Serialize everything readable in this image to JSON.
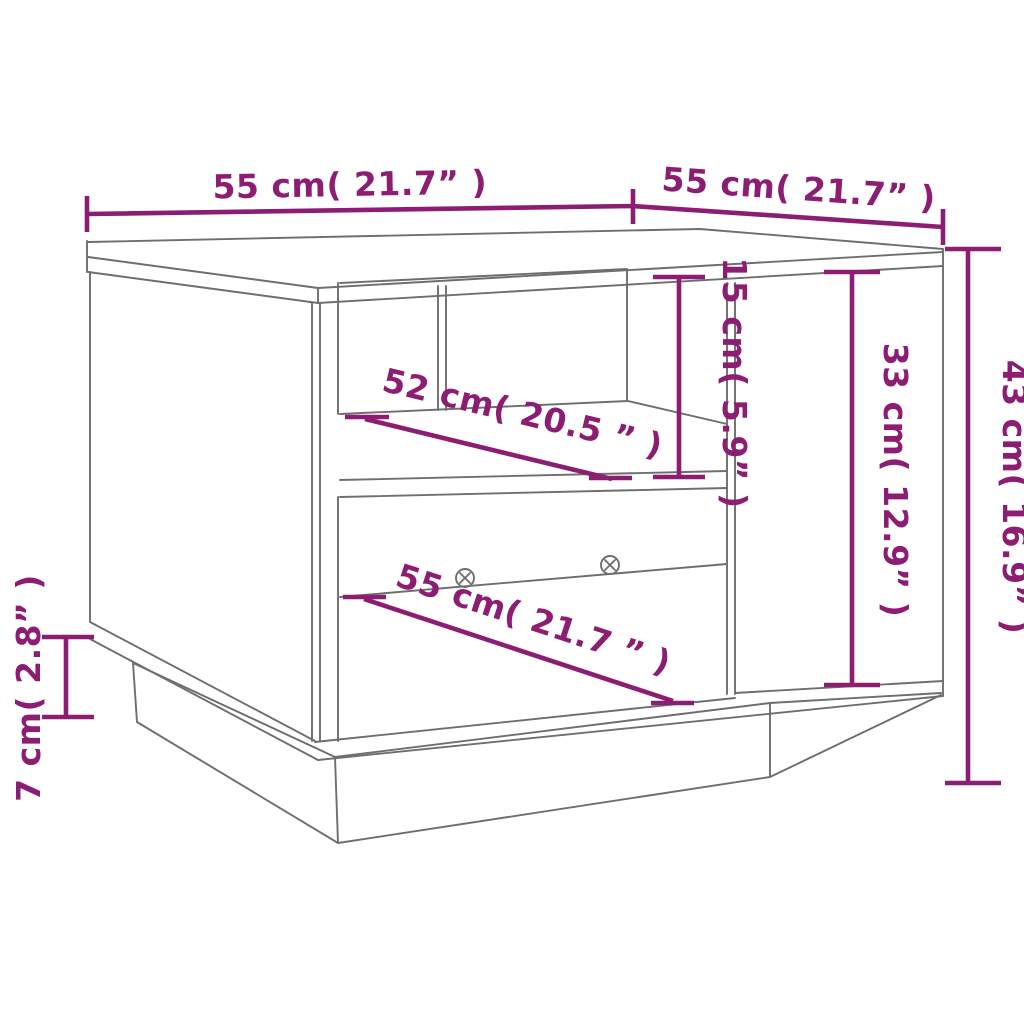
{
  "diagram": {
    "title": "coffee-table-dimension-drawing",
    "background_color": "#ffffff",
    "furniture_line_color": "#6e6e6e",
    "dimension_color": "#8C1D72",
    "dimensions": {
      "top_width": "55 cm( 21.7” )",
      "top_depth": "55 cm( 21.7” )",
      "overall_height": "43 cm( 16.9” )",
      "door_height": "33 cm( 12.9” )",
      "upper_opening_height": "15 cm( 5.9” )",
      "shelf_width": "52 cm( 20.5 ” )",
      "bottom_width": "55 cm( 21.7 ” )",
      "base_height": "7 cm( 2.8” )"
    }
  }
}
